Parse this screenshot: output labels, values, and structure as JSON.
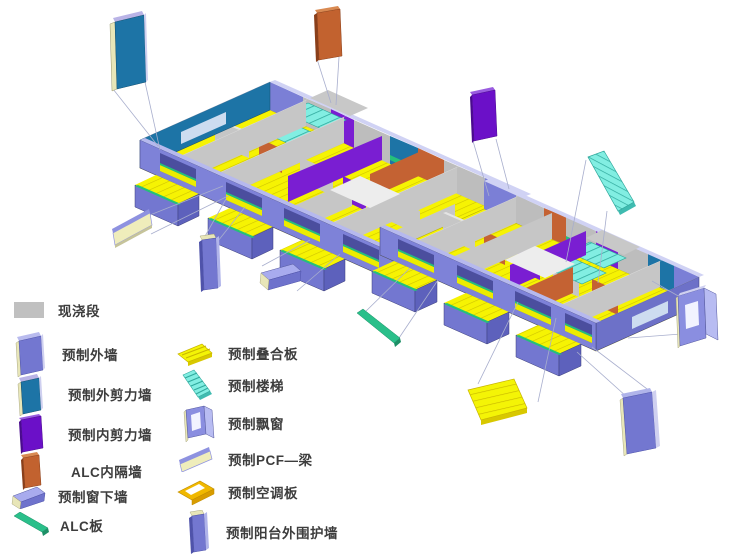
{
  "legend": {
    "col1": [
      {
        "id": "cast-in-place-segment",
        "label": "现浇段",
        "color": "#c0c0c0"
      },
      {
        "id": "precast-exterior-wall",
        "label": "预制外墙",
        "color": "#7377d0"
      },
      {
        "id": "precast-exterior-shear-wall",
        "label": "预制外剪力墙",
        "color": "#1d74a6"
      },
      {
        "id": "precast-interior-shear-wall",
        "label": "预制内剪力墙",
        "color": "#6b10c8"
      },
      {
        "id": "alc-interior-partition",
        "label": "ALC内隔墙",
        "color": "#c2622f"
      },
      {
        "id": "precast-window-sill-wall",
        "label": "预制窗下墙",
        "color": "#8d90e8"
      },
      {
        "id": "alc-panel",
        "label": "ALC板",
        "color": "#2abf8a"
      }
    ],
    "col2": [
      {
        "id": "precast-composite-slab",
        "label": "预制叠合板",
        "color": "#f4f406"
      },
      {
        "id": "precast-stairs",
        "label": "预制楼梯",
        "color": "#7ceee0"
      },
      {
        "id": "precast-bay-window",
        "label": "预制飘窗",
        "color": "#8a8ee0"
      },
      {
        "id": "precast-pcf-beam",
        "label": "预制PCF—梁",
        "color": "#efedbb"
      },
      {
        "id": "precast-ac-panel",
        "label": "预制空调板",
        "color": "#f0b800"
      },
      {
        "id": "precast-balcony-enclosure-wall",
        "label": "预制阳台外围护墙",
        "color": "#6e72cc"
      }
    ]
  },
  "model": {
    "type": "exploded-axonometric-building-diagram",
    "blocks": 2,
    "callouts": [
      {
        "id": "callout-exterior-shear-wall",
        "color": "#1d74a6"
      },
      {
        "id": "callout-alc-partition",
        "color": "#c2622f"
      },
      {
        "id": "callout-interior-shear-wall",
        "color": "#6b10c8"
      },
      {
        "id": "callout-stairs",
        "color": "#7ceee0"
      },
      {
        "id": "callout-bay-window",
        "color": "#8a8ee0"
      },
      {
        "id": "callout-exterior-wall",
        "color": "#7377d0"
      },
      {
        "id": "callout-composite-slab",
        "color": "#f4f406"
      },
      {
        "id": "callout-alc-panel",
        "color": "#2abf8a"
      },
      {
        "id": "callout-window-sill-wall",
        "color": "#8d90e8"
      },
      {
        "id": "callout-balcony-enclosure-wall",
        "color": "#6e72cc"
      },
      {
        "id": "callout-pcf-beam",
        "color": "#efedbb"
      }
    ]
  }
}
